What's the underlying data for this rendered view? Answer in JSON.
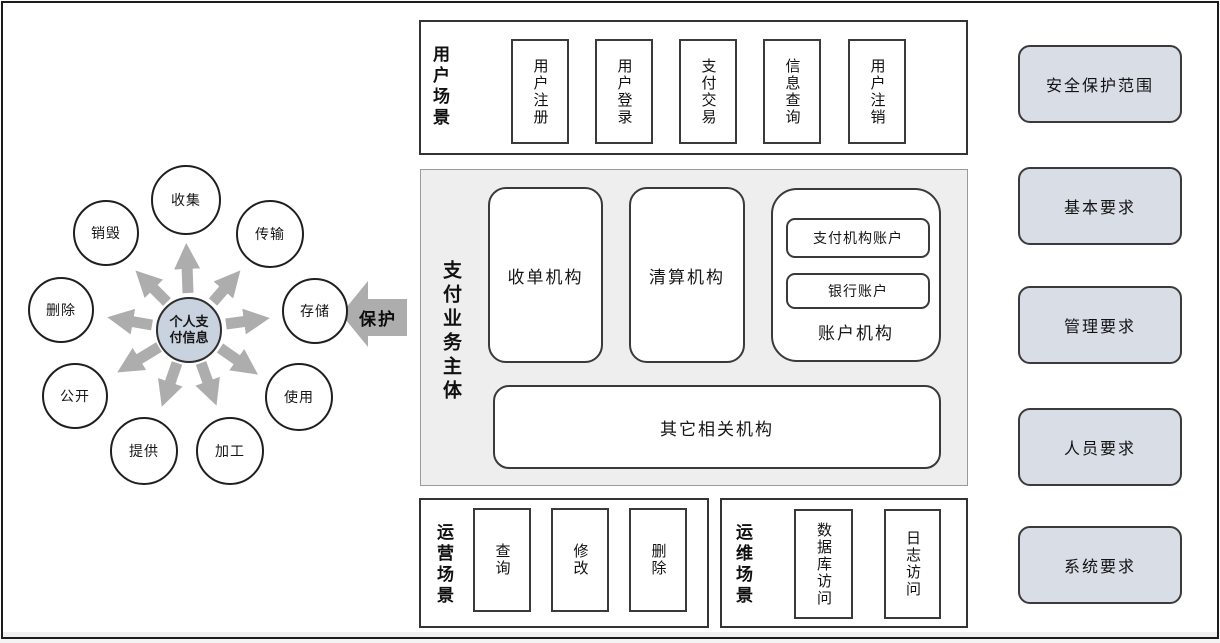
{
  "lifecycle": {
    "center_label": "个人支付信息",
    "protect_label": "保护",
    "stages": [
      "收集",
      "传输",
      "存储",
      "使用",
      "加工",
      "提供",
      "公开",
      "删除",
      "销毁"
    ]
  },
  "user_scenarios": {
    "label": "用户场景",
    "items": [
      "用户注册",
      "用户登录",
      "支付交易",
      "信息查询",
      "用户注销"
    ]
  },
  "payment_body": {
    "label": "支付业务主体",
    "boxes": [
      "收单机构",
      "清算机构"
    ],
    "account_group": {
      "label": "账户机构",
      "accounts": [
        "支付机构账户",
        "银行账户"
      ]
    },
    "other_box": "其它相关机构"
  },
  "operation_scenarios": {
    "label": "运营场景",
    "items": [
      "查询",
      "修改",
      "删除"
    ]
  },
  "maintenance_scenarios": {
    "label": "运维场景",
    "items": [
      "数据库访问",
      "日志访问"
    ]
  },
  "requirements": [
    "安全保护范围",
    "基本要求",
    "管理要求",
    "人员要求",
    "系统要求"
  ],
  "colors": {
    "section_bg": "#efeeee",
    "requirement_fill": "#d8dde6",
    "center_circle_fill": "#c9d3e0",
    "arrow_gray": "#adadad",
    "border_dark": "#343434"
  }
}
